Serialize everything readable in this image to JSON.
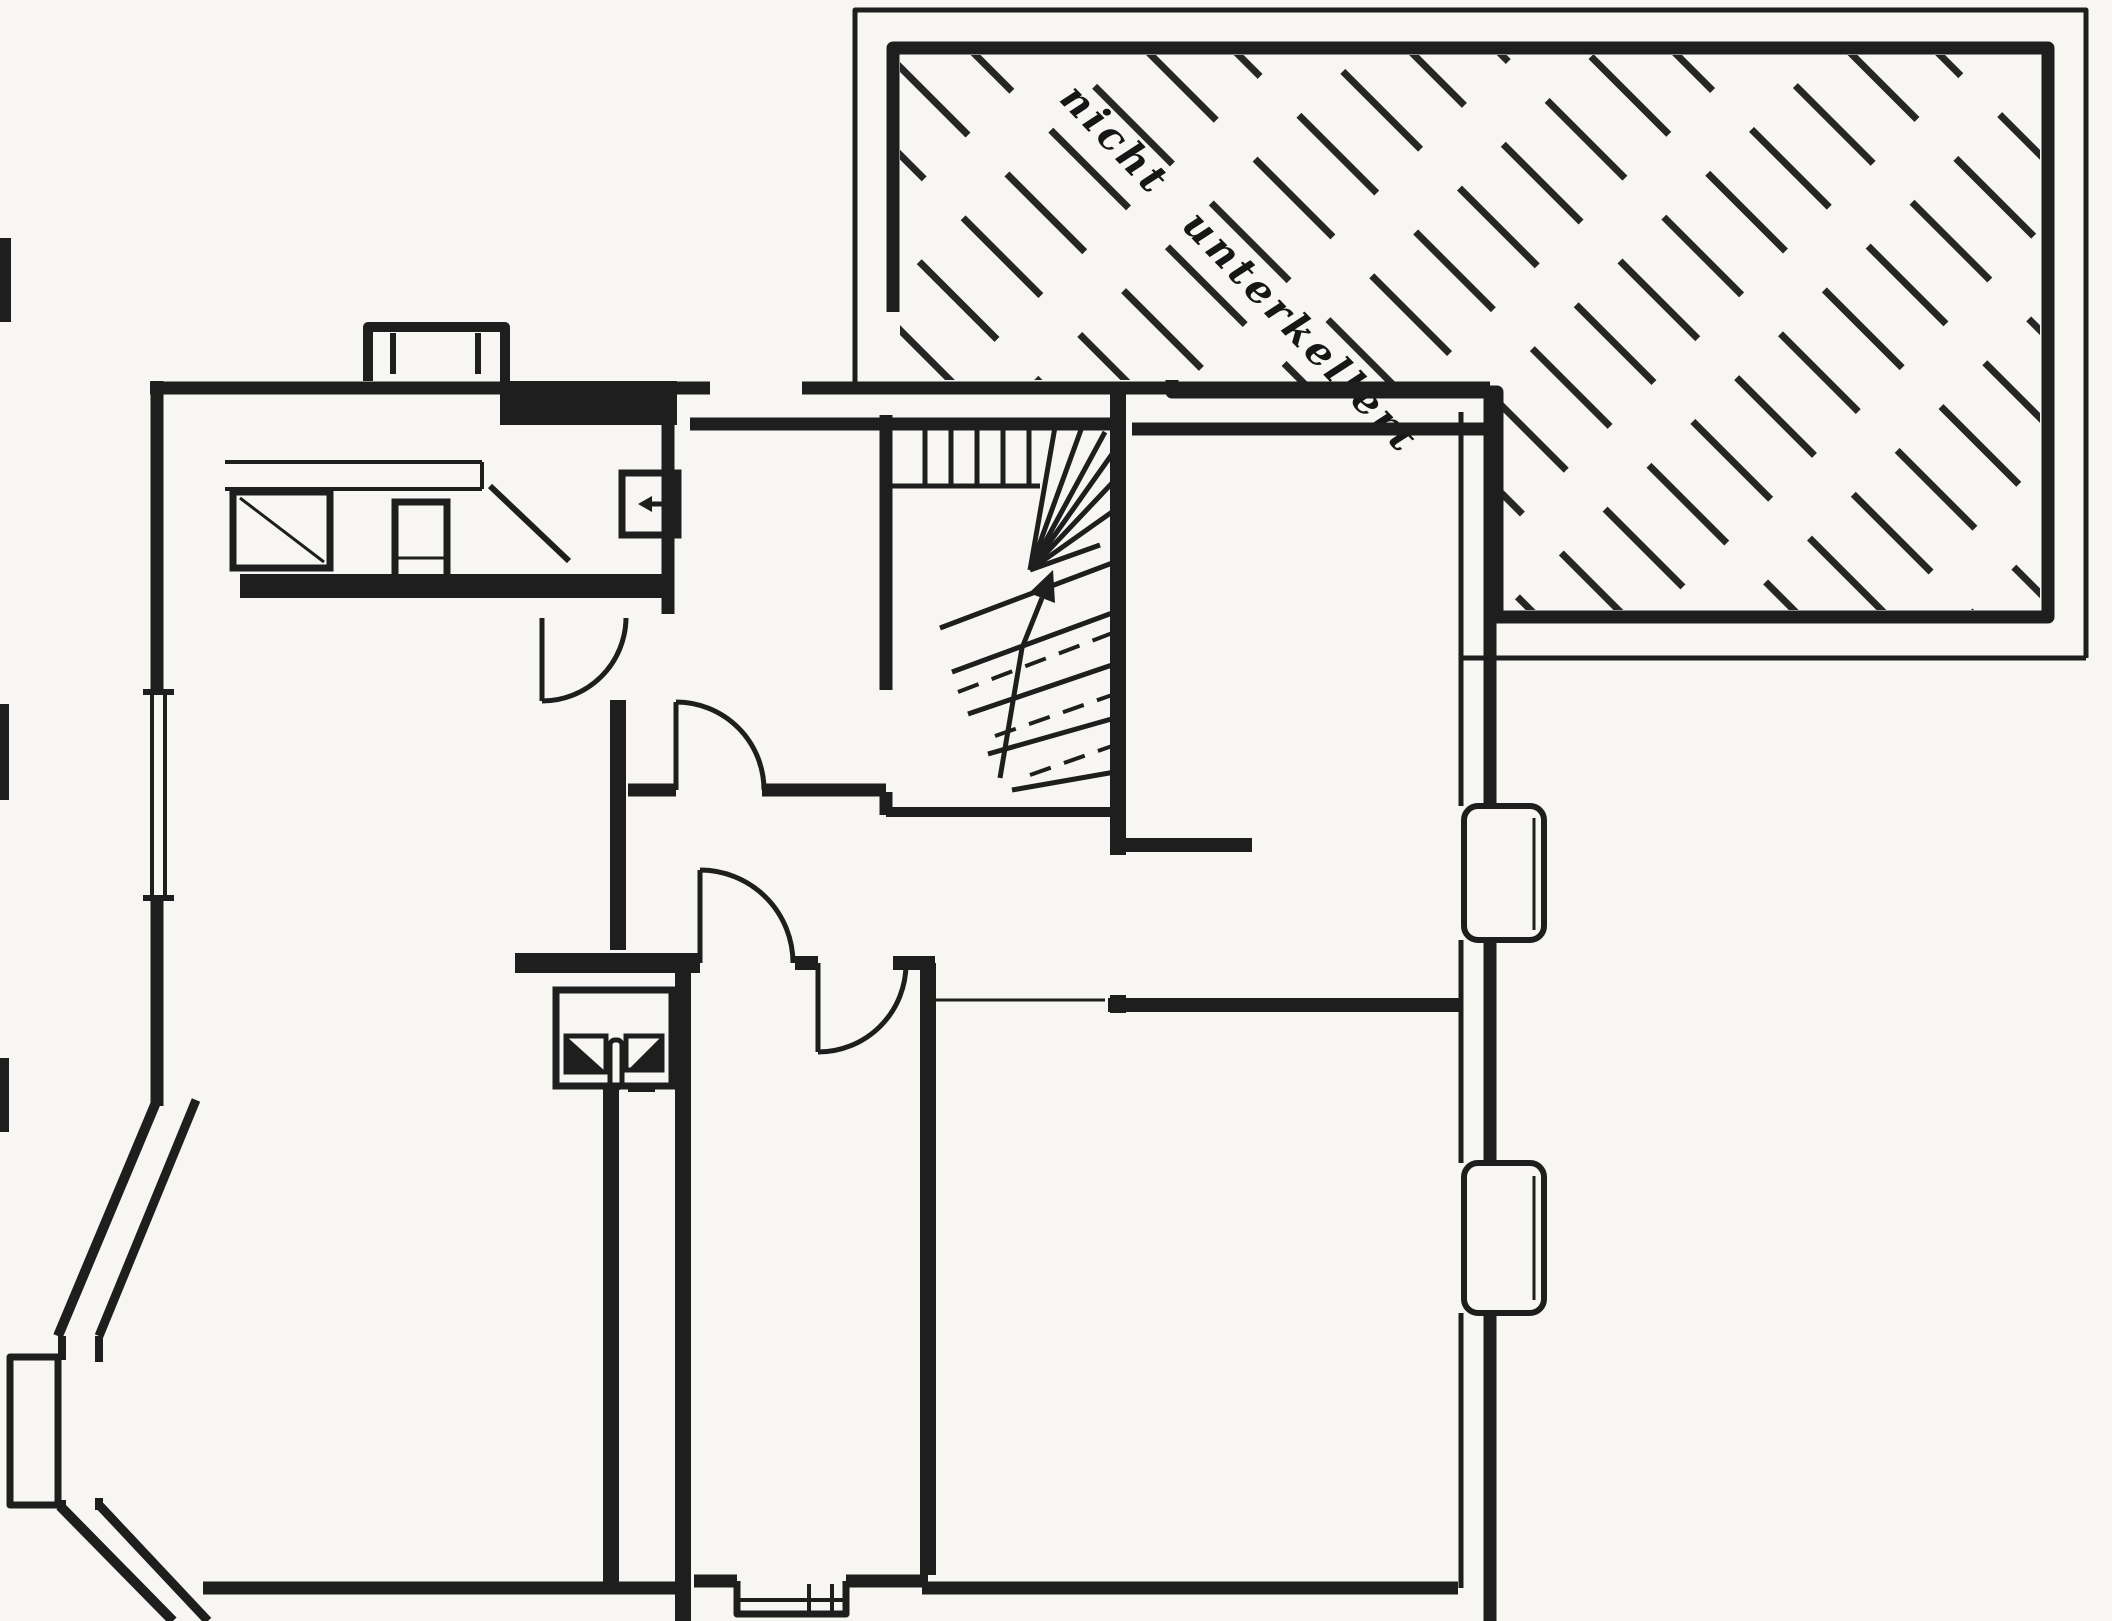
{
  "page": {
    "background": "#e9e7e2"
  },
  "plan": {
    "annotation": {
      "text": "nicht unterkellert",
      "rotation_deg": 46
    },
    "colors": {
      "paper": "#f7f6f2",
      "ink": "#1e1e1e"
    },
    "symbols": [
      {
        "name": "unexcavated-hatch-area",
        "label": "nicht unterkellert"
      },
      {
        "name": "winder-staircase",
        "direction_arrow": "up"
      },
      {
        "name": "door-swing-arc",
        "count": 4
      },
      {
        "name": "door-leaf-diagonal",
        "count": 1
      },
      {
        "name": "window",
        "count": 5
      },
      {
        "name": "bay-window",
        "count": 1
      },
      {
        "name": "bottom-window-bay",
        "count": 1
      },
      {
        "name": "chimney-flue-box",
        "count": 2
      },
      {
        "name": "wash-basin",
        "count": 1
      },
      {
        "name": "cistern",
        "count": 1
      },
      {
        "name": "duct-box-with-arrow",
        "count": 1
      }
    ]
  }
}
